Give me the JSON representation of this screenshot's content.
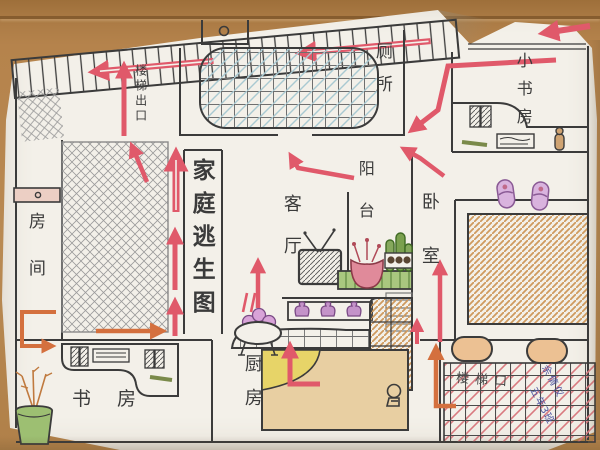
{
  "title": {
    "text": "家庭逃生图"
  },
  "rooms": {
    "toilet": "厕所",
    "small_study": "小书房",
    "room": "房间",
    "living_room": "客厅",
    "balcony": "阳台",
    "bedroom": "卧室",
    "study": "书房",
    "kitchen": "厨房"
  },
  "annotations": {
    "stairs_exit": "楼梯出口",
    "blanket_note": "楼梯口",
    "signature_line1": "余倩仪",
    "signature_line2": "五年3班"
  },
  "colors": {
    "marker_red": "#e0596a",
    "marker_orange": "#d4703e",
    "pen_ink": "#3b3b3b",
    "pen_blue": "#4f55a0",
    "paper": "#f3f0e9",
    "wood_desk": "#b5834c"
  },
  "objects": [
    "stairs-corridor",
    "double-bed-grid",
    "pencil-bed-crosshatch",
    "door-with-knob",
    "tv-with-antenna",
    "flower-pot",
    "cactus-plants",
    "balcony-shelf-jars",
    "radiator",
    "slippers",
    "bed-orange-hatch",
    "pillows",
    "grid-blanket",
    "desk-with-books",
    "keyboard",
    "pen",
    "potted-plant",
    "kitchen-counter",
    "stove-pot-with-buns",
    "wall-shelf-jars",
    "small-figure"
  ]
}
